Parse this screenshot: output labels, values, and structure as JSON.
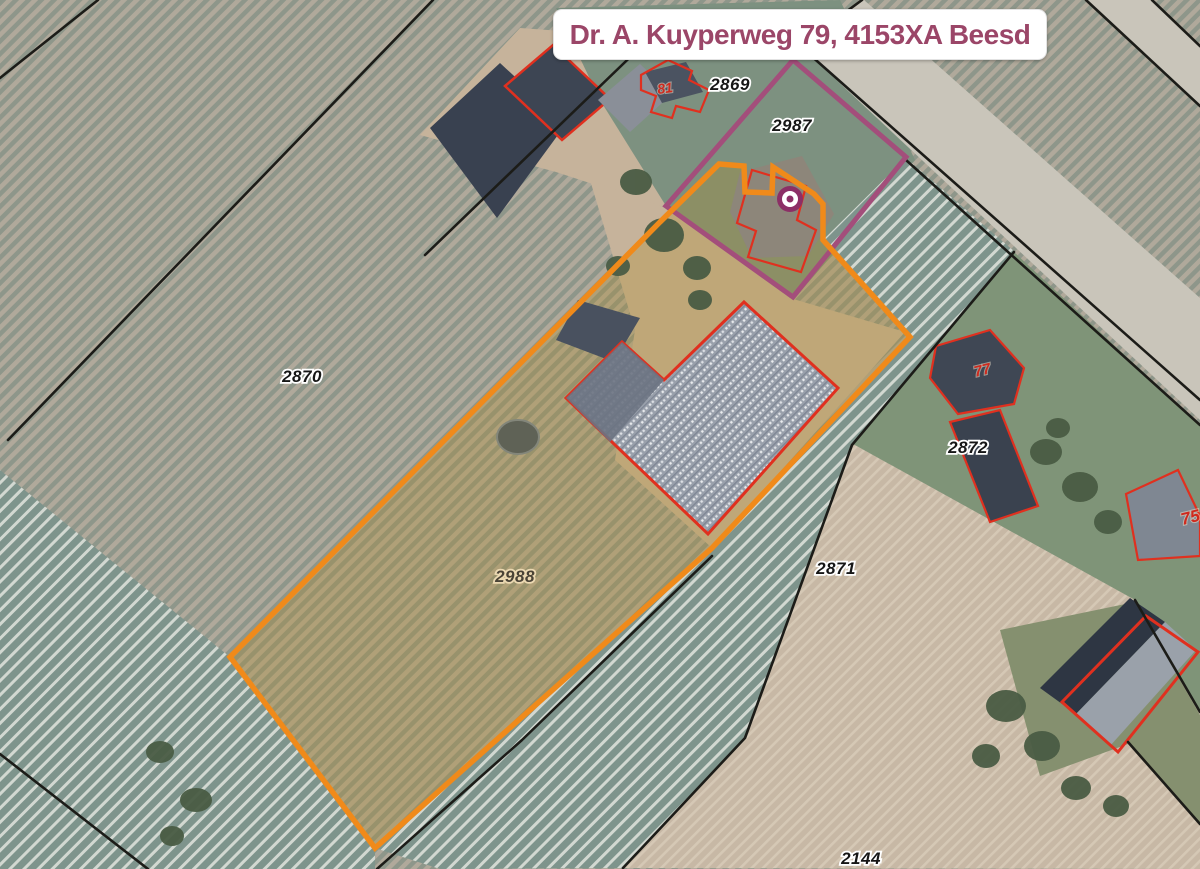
{
  "banner": {
    "address": "Dr. A. Kuyperweg 79, 4153XA Beesd"
  },
  "parcels": [
    {
      "number": "2869"
    },
    {
      "number": "2987"
    },
    {
      "number": "2870"
    },
    {
      "number": "2872"
    },
    {
      "number": "2988",
      "selected": true
    },
    {
      "number": "2871"
    },
    {
      "number": "2144"
    }
  ],
  "house_numbers": [
    {
      "number": "81"
    },
    {
      "number": "77"
    },
    {
      "number": "75"
    }
  ],
  "marker": {
    "type": "address-point"
  },
  "colors": {
    "selected_parcel_boundary": "#F08A1A",
    "address_parcel_boundary": "#A34E7B",
    "building_outline": "#E0301F",
    "cadastral_line": "#1C1C18",
    "banner_text": "#9B4668",
    "marker": "#8C2F66"
  }
}
